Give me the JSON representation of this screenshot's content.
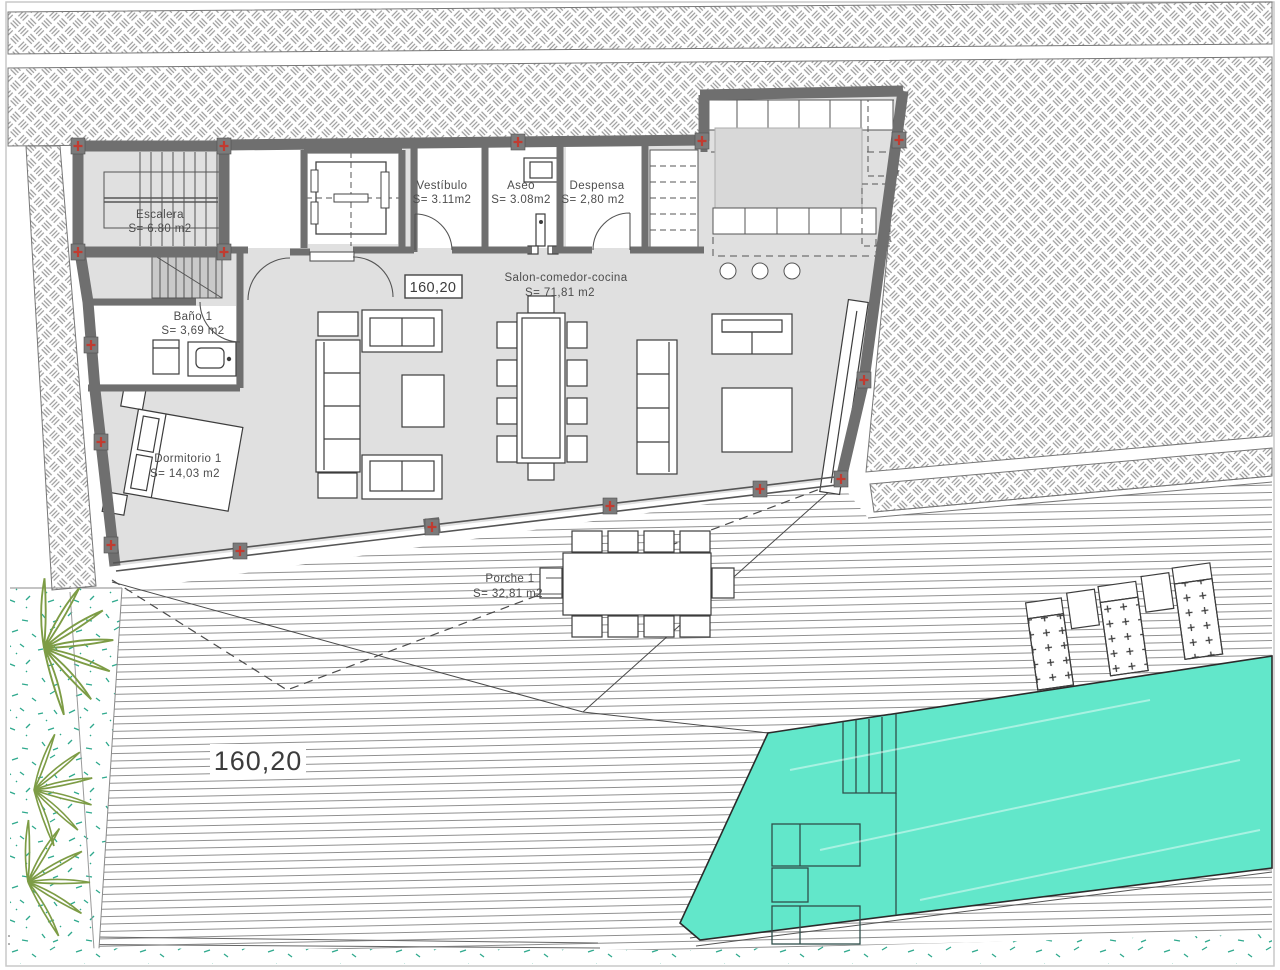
{
  "plan": {
    "type": "architectural-floor-plan",
    "rooms": [
      {
        "id": "escalera",
        "name": "Escalera",
        "area": "S= 6.80 m2"
      },
      {
        "id": "vestibulo",
        "name": "Vestíbulo",
        "area": "S= 3.11m2"
      },
      {
        "id": "aseo",
        "name": "Aseo",
        "area": "S= 3.08m2"
      },
      {
        "id": "despensa",
        "name": "Despensa",
        "area": "S= 2,80 m2"
      },
      {
        "id": "salon",
        "name": "Salon-comedor-cocina",
        "area": "S= 71,81 m2"
      },
      {
        "id": "bano",
        "name": "Baño 1",
        "area": "S= 3,69 m2"
      },
      {
        "id": "dormitorio",
        "name": "Dormitorio 1",
        "area": "S= 14,03 m2"
      },
      {
        "id": "porche",
        "name": "Porche 1",
        "area": "S= 32,81 m2"
      }
    ],
    "elevation_marks": {
      "boxed": "160,20",
      "ground": "160,20"
    },
    "colors": {
      "pool": "#62E7CA",
      "wall": "#6F6F6F",
      "floor": "#E0E0E0",
      "marker_red": "#C13B30",
      "hatch_line": "#9B9B9B",
      "deck_line": "#8F8F8F",
      "leaf_green": "#7D9C45",
      "grass_teal": "#2FA98D"
    }
  }
}
